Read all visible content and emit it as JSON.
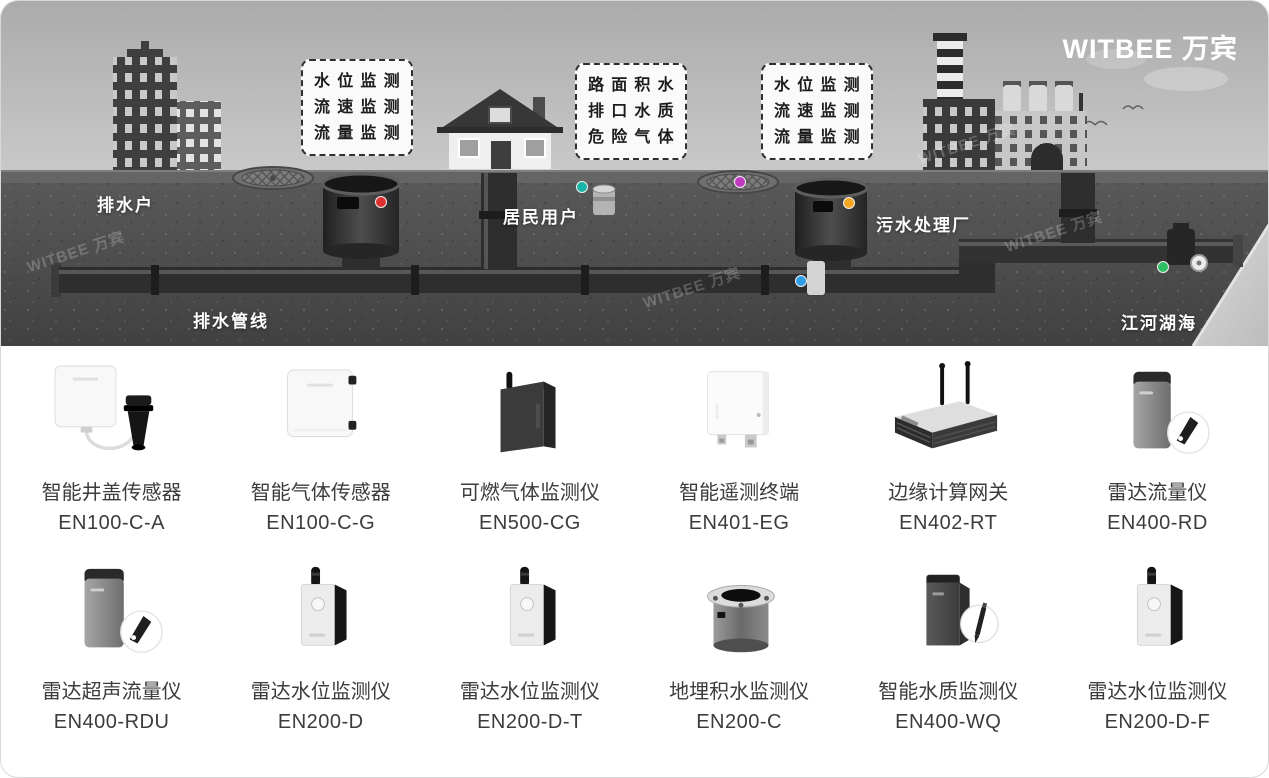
{
  "brand": {
    "logo": "WITBEE 万宾",
    "watermark": "WITBEE 万宾"
  },
  "scene": {
    "labels": {
      "drain_user": "排水户",
      "residents": "居民用户",
      "sewage_plant": "污水处理厂",
      "drain_pipeline": "排水管线",
      "rivers": "江河湖海"
    },
    "callouts": [
      {
        "lines": [
          "水位监测",
          "流速监测",
          "流量监测"
        ]
      },
      {
        "lines": [
          "路面积水",
          "排口水质",
          "危险气体"
        ]
      },
      {
        "lines": [
          "水位监测",
          "流速监测",
          "流量监测"
        ]
      }
    ],
    "indicator_colors": {
      "red": "#e03131",
      "teal": "#18b3a6",
      "magenta": "#c03ac0",
      "orange": "#f5a623",
      "blue": "#2e9fe6",
      "green": "#2fbf63"
    }
  },
  "products": [
    {
      "name": "智能井盖传感器",
      "model": "EN100-C-A"
    },
    {
      "name": "智能气体传感器",
      "model": "EN100-C-G"
    },
    {
      "name": "可燃气体监测仪",
      "model": "EN500-CG"
    },
    {
      "name": "智能遥测终端",
      "model": "EN401-EG"
    },
    {
      "name": "边缘计算网关",
      "model": "EN402-RT"
    },
    {
      "name": "雷达流量仪",
      "model": "EN400-RD"
    },
    {
      "name": "雷达超声流量仪",
      "model": "EN400-RDU"
    },
    {
      "name": "雷达水位监测仪",
      "model": "EN200-D"
    },
    {
      "name": "雷达水位监测仪",
      "model": "EN200-D-T"
    },
    {
      "name": "地埋积水监测仪",
      "model": "EN200-C"
    },
    {
      "name": "智能水质监测仪",
      "model": "EN400-WQ"
    },
    {
      "name": "雷达水位监测仪",
      "model": "EN200-D-F"
    }
  ]
}
